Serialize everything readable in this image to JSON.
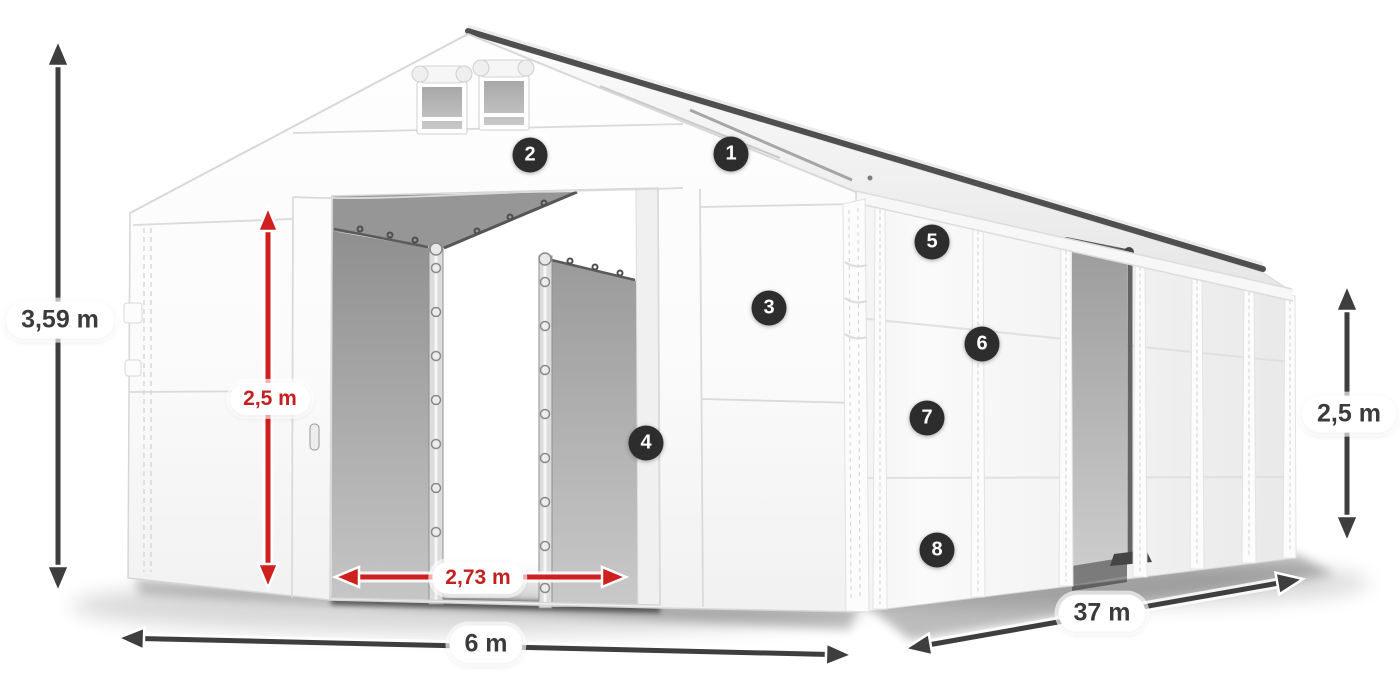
{
  "colors": {
    "background": "#ffffff",
    "arrow_dark": "#3e3e3e",
    "arrow_red": "#cf1f1f",
    "label_text_dark": "#3b3b3b",
    "label_text_red": "#c42020",
    "pill_bg": "#ffffff",
    "badge_bg": "#2d2d2d",
    "badge_text": "#ffffff"
  },
  "dimensions": {
    "total_height": "3,59 m",
    "entrance_height": "2,5 m",
    "entrance_width": "2,73 m",
    "front_width": "6 m",
    "side_length": "37 m",
    "side_wall_height": "2,5 m"
  },
  "hotspots": [
    {
      "number": "1"
    },
    {
      "number": "2"
    },
    {
      "number": "3"
    },
    {
      "number": "4"
    },
    {
      "number": "5"
    },
    {
      "number": "6"
    },
    {
      "number": "7"
    },
    {
      "number": "8"
    }
  ]
}
